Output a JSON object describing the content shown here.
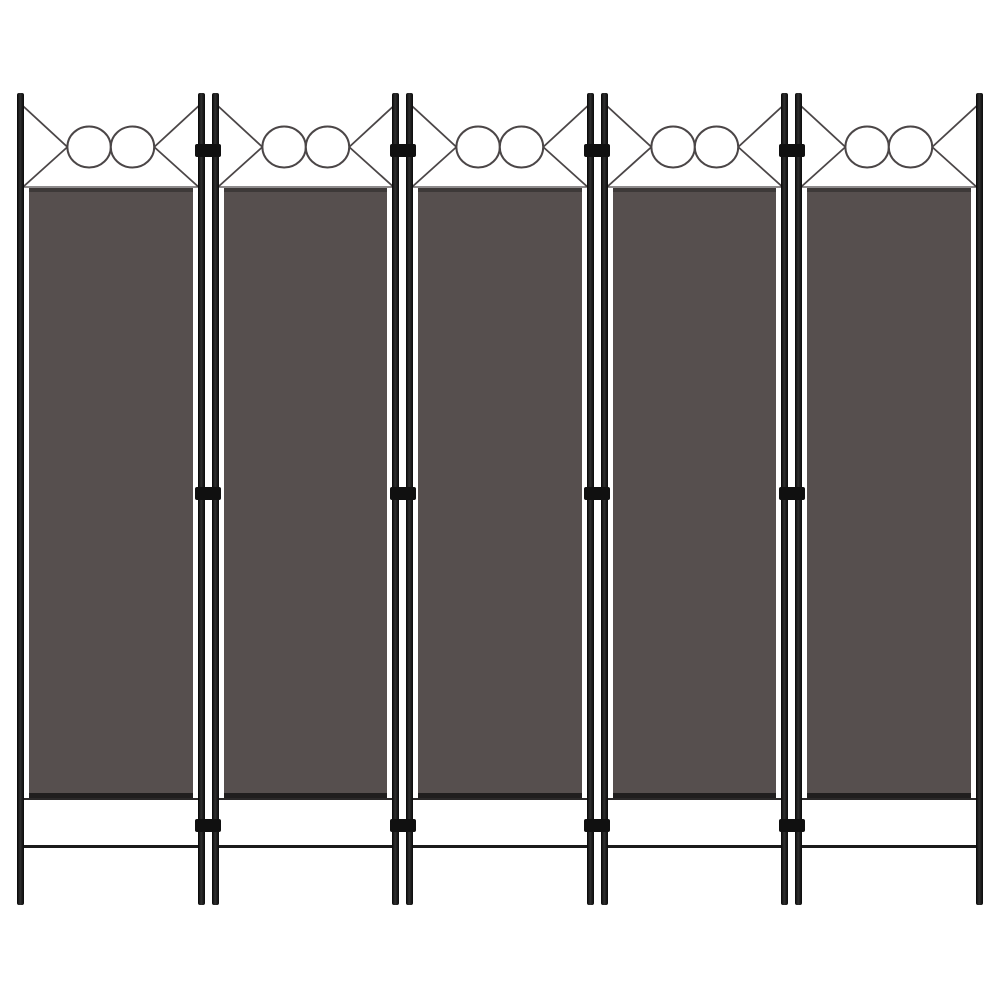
{
  "scene": {
    "description": "Product photo of a 5-panel folding room divider screen with anthracite fabric panels, black metal frame poles, decorative crossed wires with twin circles above each panel, three hinges at each junction, and raised legs with a lower stretcher rail",
    "background_color": "#ffffff"
  },
  "divider": {
    "panel_count": 5,
    "junction_count": 4,
    "hinges_per_junction": 3,
    "circles_per_panel": 2,
    "colors": {
      "pole": "#161616",
      "hinge": "#101010",
      "fabric": "#564f4e",
      "fabric_top_edge": "#3d3938",
      "fabric_bottom_bar": "#201e1e",
      "wire": "#4b4647",
      "stretcher": "#1b1b1b",
      "circle_fill": "#ffffff"
    }
  }
}
